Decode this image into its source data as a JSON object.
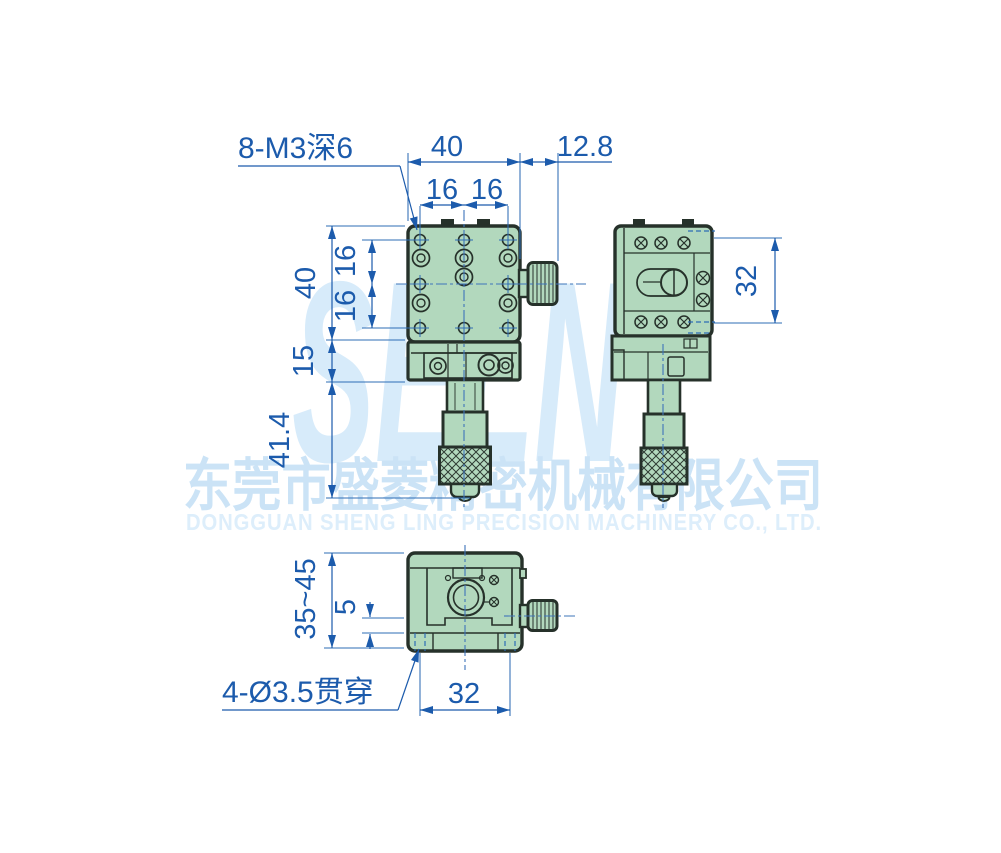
{
  "watermark": {
    "logo": "SELN",
    "company_cn": "东莞市盛菱精密机械有限公司",
    "company_en": "DONGGUAN SHENG LING PRECISION MACHINERY CO., LTD."
  },
  "callouts": {
    "tapped_holes": "8-M3深6",
    "through_holes": "4-Ø3.5贯穿"
  },
  "dimensions": {
    "front_top_width": "40",
    "front_knob_offset": "12.8",
    "front_top_pitch_a": "16",
    "front_top_pitch_b": "16",
    "front_left_height": "40",
    "front_left_pitch_a": "16",
    "front_left_pitch_b": "16",
    "front_base_height": "15",
    "front_micrometer_length": "41.4",
    "side_screw_span": "32",
    "bottom_height_range": "35~45",
    "bottom_plate_thickness": "5",
    "bottom_hole_span": "32"
  },
  "colors": {
    "body_green": "#b2d8bd",
    "outline_dark": "#26312a",
    "dimension_blue": "#1c5bac",
    "watermark_light_blue": "#d7ebfa"
  }
}
